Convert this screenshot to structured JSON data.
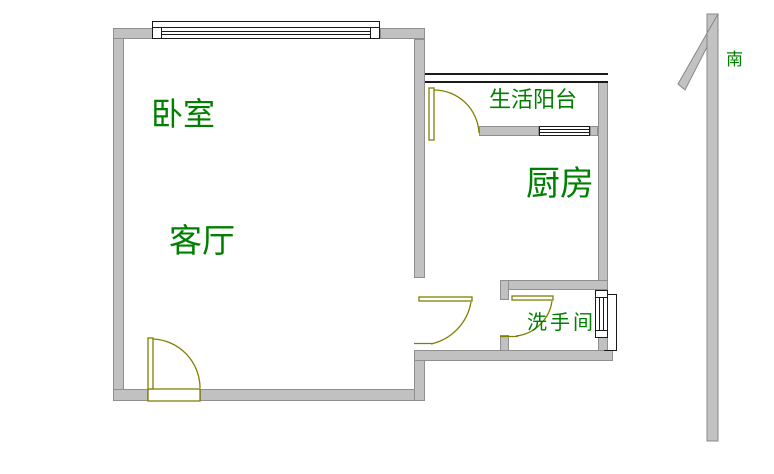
{
  "floor_plan": {
    "title": "one-bedroom apartment floor plan",
    "rooms": [
      {
        "id": "bedroom",
        "label": "卧室"
      },
      {
        "id": "living_room",
        "label": "客厅"
      },
      {
        "id": "balcony",
        "label": "生活阳台"
      },
      {
        "id": "kitchen",
        "label": "厨房"
      },
      {
        "id": "bathroom",
        "label": "洗手间"
      }
    ],
    "compass": {
      "label": "南",
      "direction": "arrow-points-up"
    },
    "symbols": {
      "doors": [
        "entrance-door",
        "balcony-door",
        "kitchen-door",
        "bathroom-door"
      ],
      "windows": [
        "bedroom-window",
        "balcony-kitchen-window",
        "bathroom-window",
        "balcony-railing"
      ],
      "compass_arrow": "south-arrow-icon"
    },
    "colors": {
      "wall_fill": "#c1c1c1",
      "wall_border": "#8f8f8f",
      "door_line": "#7f7f00",
      "window_line": "#1a1a1a",
      "label_text": "#008000",
      "background": "#ffffff"
    }
  }
}
